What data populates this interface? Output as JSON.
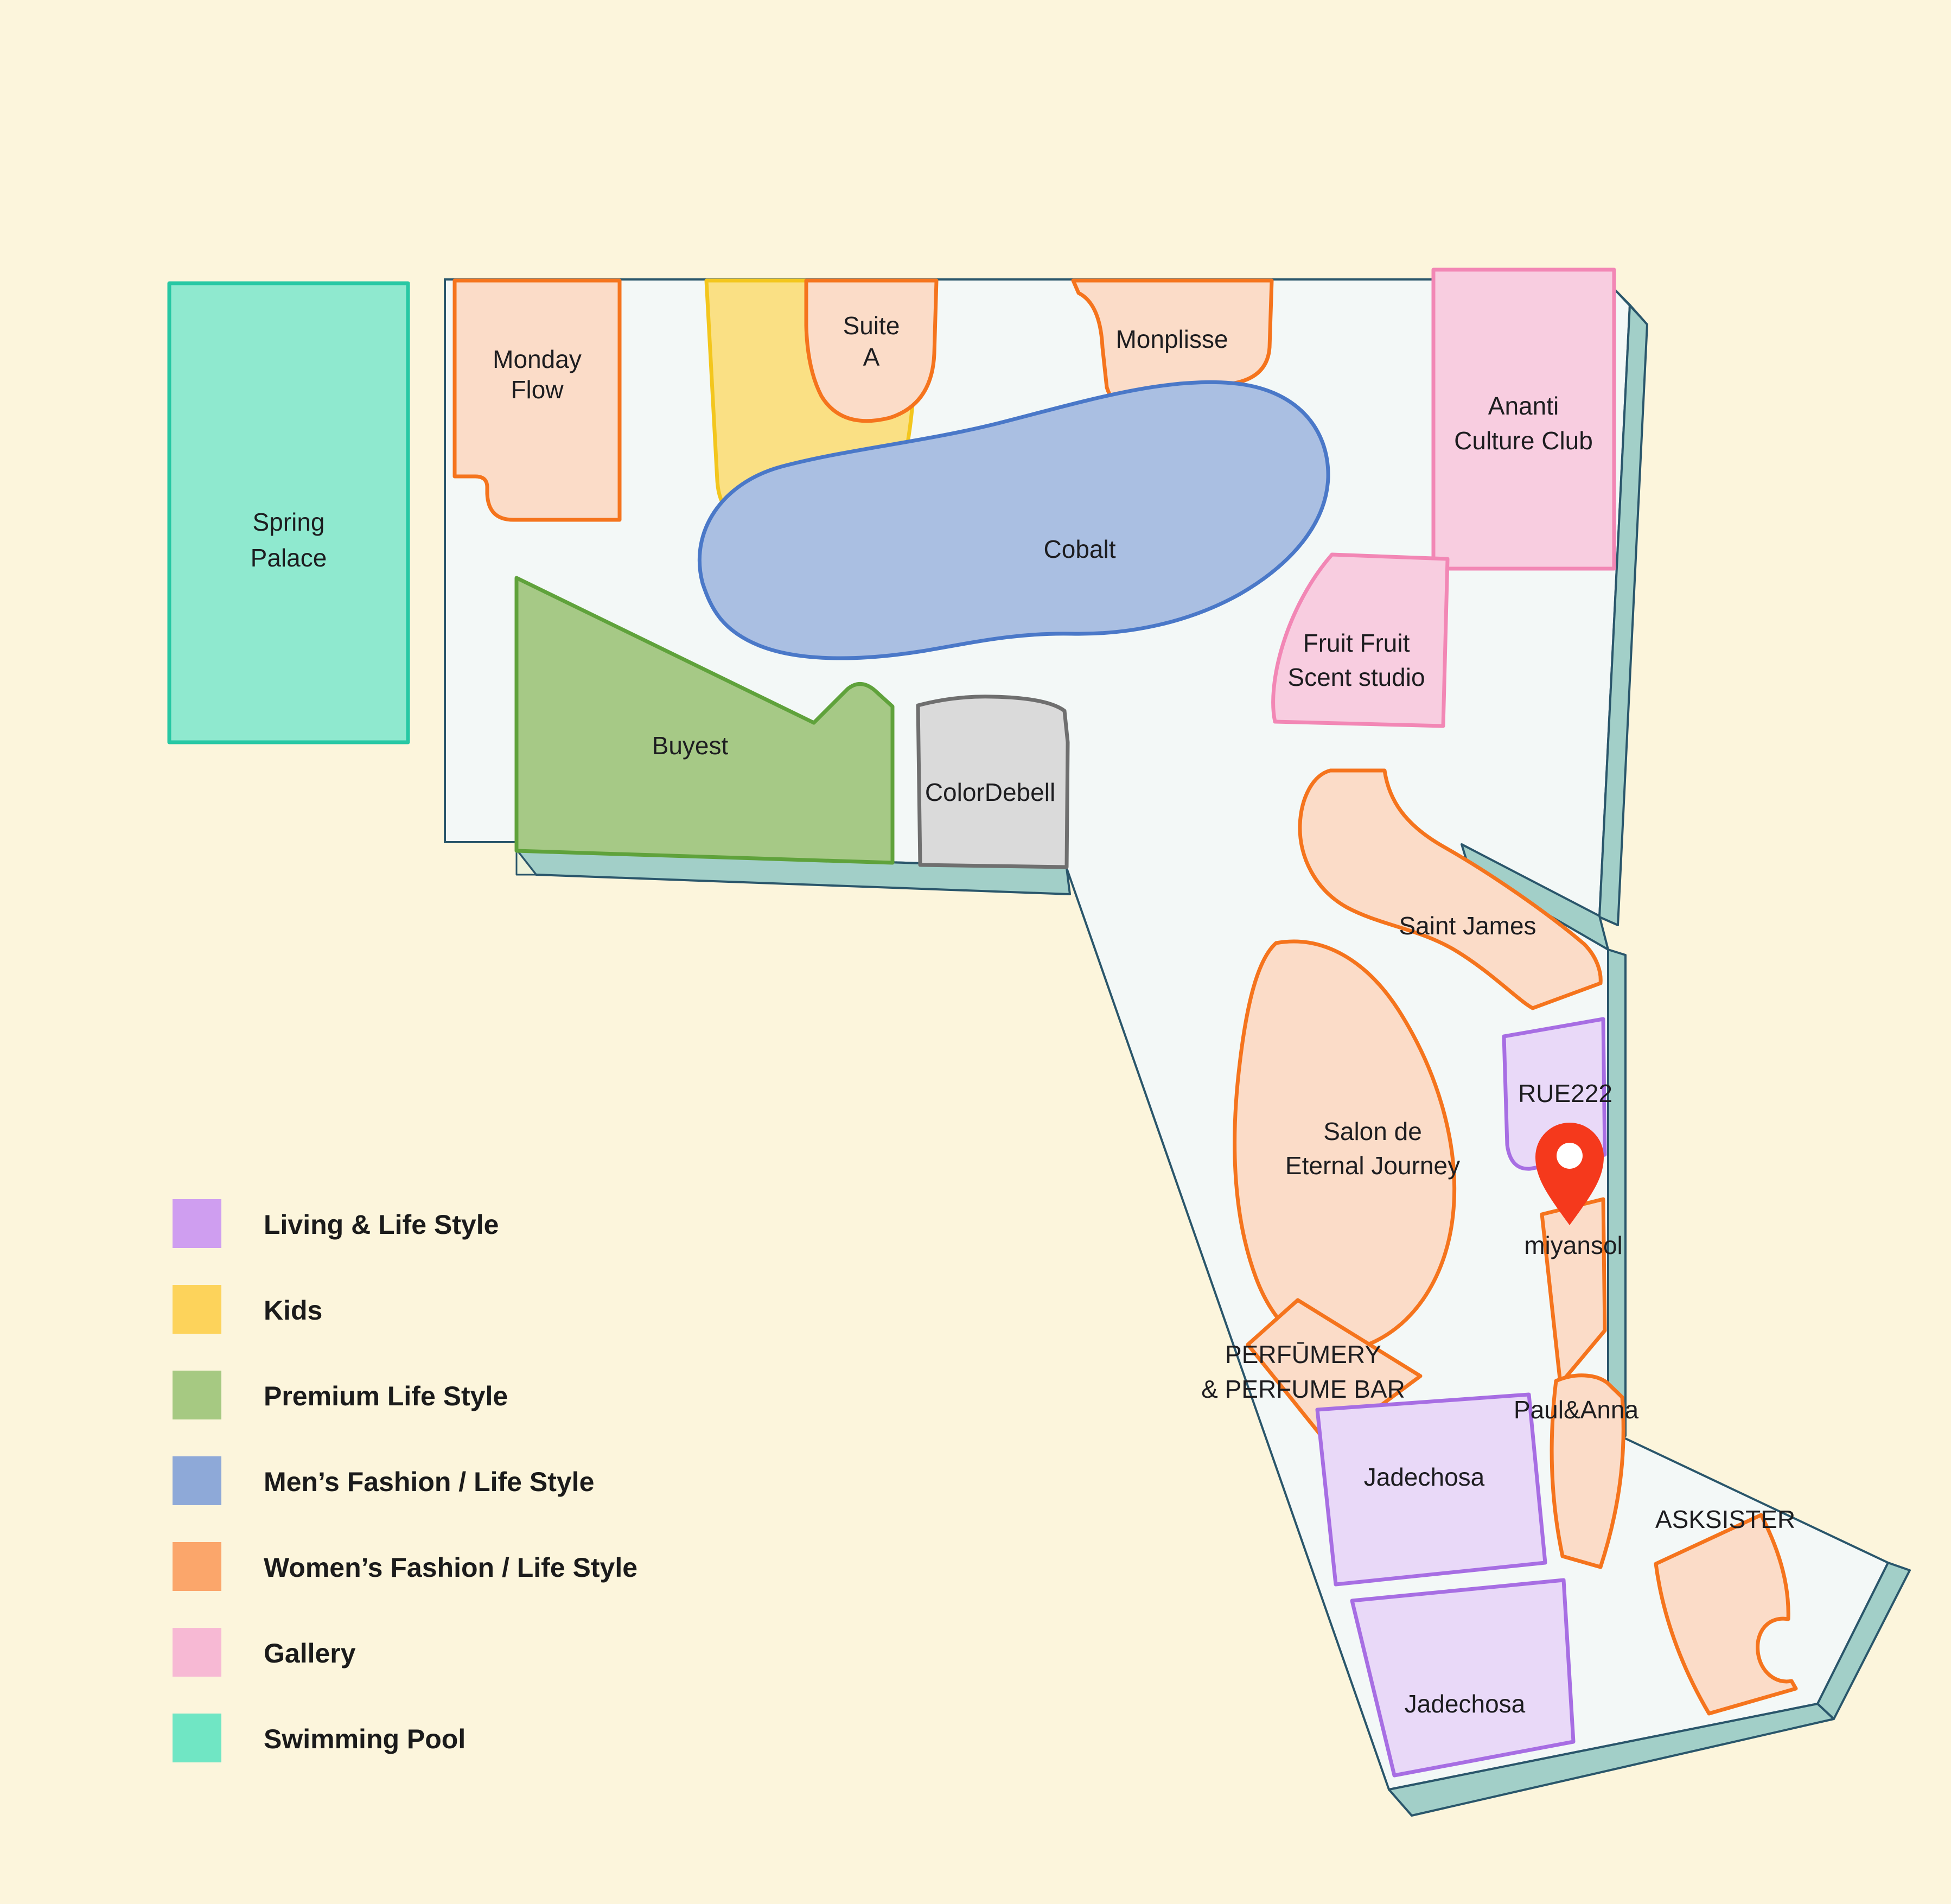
{
  "map": {
    "shops": {
      "spring_palace": {
        "line1": "Spring",
        "line2": "Palace"
      },
      "monday_flow": {
        "line1": "Monday",
        "line2": "Flow"
      },
      "suite_a": {
        "line1": "Suite",
        "line2": "A"
      },
      "monplisse": {
        "label": "Monplisse"
      },
      "ananti": {
        "line1": "Ananti",
        "line2": "Culture Club"
      },
      "cobalt": {
        "label": "Cobalt"
      },
      "fruit_fruit": {
        "line1": "Fruit Fruit",
        "line2": "Scent studio"
      },
      "buyest": {
        "label": "Buyest"
      },
      "colordebell": {
        "label": "ColorDebell"
      },
      "saint_james": {
        "label": "Saint James"
      },
      "salon": {
        "line1": "Salon de",
        "line2": "Eternal Journey"
      },
      "rue222": {
        "label": "RUE222"
      },
      "miyansol": {
        "label": "miyansol"
      },
      "perfumery": {
        "line1": "PERFŪMERY",
        "line2": "& PERFUME BAR"
      },
      "paul_anna": {
        "label": "Paul&Anna"
      },
      "jadechosa_upper": {
        "label": "Jadechosa"
      },
      "jadechosa_lower": {
        "label": "Jadechosa"
      },
      "asksister": {
        "label": "ASKSISTER"
      }
    },
    "marker": {
      "target": "miyansol",
      "color": "#f5391c"
    }
  },
  "legend": {
    "items": [
      {
        "label": "Living & Life Style",
        "color": "#cf9ef0"
      },
      {
        "label": "Kids",
        "color": "#fdd35b"
      },
      {
        "label": "Premium Life Style",
        "color": "#a6c982"
      },
      {
        "label": "Men’s Fashion / Life Style",
        "color": "#8ea9d8"
      },
      {
        "label": "Women’s Fashion / Life Style",
        "color": "#fba66b"
      },
      {
        "label": "Gallery",
        "color": "#f7b9d4"
      },
      {
        "label": "Swimming Pool",
        "color": "#70e6c4"
      }
    ]
  },
  "colors": {
    "background": "#fcf5dc",
    "floor": "#f3f8f7",
    "outline": "#2a566b",
    "wall": "#a2cfc8",
    "wall_wedge": "#edf2d9",
    "shape_fills": {
      "womens": "#fbdcc8",
      "living": "#e9d9f8",
      "kids": "#fae084",
      "premium": "#a6c986",
      "mens": "#aabfe2",
      "gallery": "#f8cde0",
      "pool": "#8fe9cf",
      "neutral": "#dadada"
    }
  }
}
